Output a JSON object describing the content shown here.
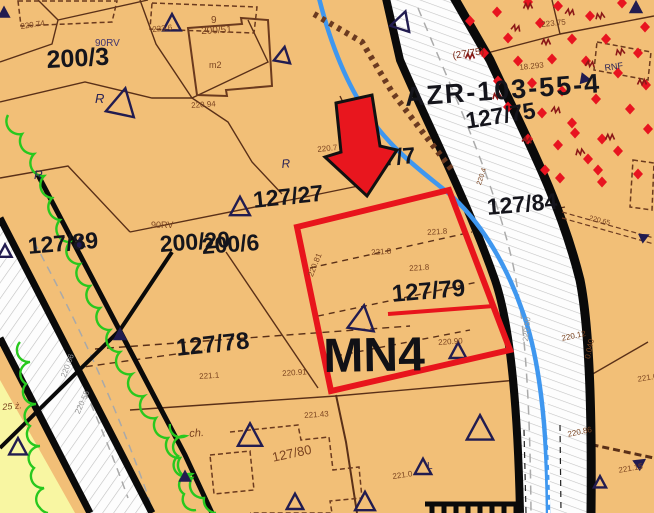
{
  "map": {
    "zone_code": "MN4",
    "highlighted_parcel": "127/79",
    "plan_reference": "AZR-103-55-4",
    "colors": {
      "background": "#f2bf77",
      "road_fill": "#fdfdfd",
      "outline_red": "#e8141c",
      "arrow_red": "#e8161e",
      "stream_blue": "#3f97ef",
      "vegetation_green": "#28c81e",
      "meadow_yellow": "#f8f6a2",
      "diamond_red": "#e81420",
      "symbol_navy": "#221c50",
      "zigzag_darkred": "#8b1717",
      "boundary_brown": "#6b3a20",
      "label_black": "#15151c",
      "label_brown": "#7b4420",
      "label_gray": "#969696"
    },
    "labels": [
      {
        "t": "200/3",
        "x": 46,
        "y": 48,
        "s": 25,
        "c": "#15151c",
        "r": -3,
        "w": 700
      },
      {
        "t": "AZR-103-55-4",
        "x": 404,
        "y": 84,
        "s": 27,
        "c": "#15151c",
        "r": -4,
        "w": 700,
        "ls": 2
      },
      {
        "t": "127/75",
        "x": 464,
        "y": 110,
        "s": 23,
        "c": "#15151c",
        "r": -9,
        "w": 700
      },
      {
        "t": "127/7",
        "x": 357,
        "y": 149,
        "s": 23,
        "c": "#15151c",
        "r": -5,
        "w": 700
      },
      {
        "t": "127/84",
        "x": 486,
        "y": 196,
        "s": 23,
        "c": "#15151c",
        "r": -5,
        "w": 700
      },
      {
        "t": "127/27",
        "x": 252,
        "y": 189,
        "s": 23,
        "c": "#15151c",
        "r": -6,
        "w": 700
      },
      {
        "t": "127/89",
        "x": 27,
        "y": 235,
        "s": 23,
        "c": "#15151c",
        "r": -5,
        "w": 700
      },
      {
        "t": "200/20",
        "x": 159,
        "y": 233,
        "s": 23,
        "c": "#15151c",
        "r": -4,
        "w": 700
      },
      {
        "t": "200/6",
        "x": 201,
        "y": 235,
        "s": 23,
        "c": "#15151c",
        "r": -4,
        "w": 700
      },
      {
        "t": "127/79",
        "x": 391,
        "y": 283,
        "s": 24,
        "c": "#15151c",
        "r": -5,
        "w": 700
      },
      {
        "t": "MN4",
        "x": 323,
        "y": 333,
        "s": 48,
        "c": "#111116",
        "r": -1,
        "w": 800
      },
      {
        "t": "127/78",
        "x": 175,
        "y": 337,
        "s": 24,
        "c": "#15151c",
        "r": -6,
        "w": 700
      },
      {
        "t": "220.74",
        "x": 20,
        "y": 23,
        "s": 8,
        "c": "#7b4420",
        "r": -8
      },
      {
        "t": "223.6",
        "x": 152,
        "y": 26,
        "s": 8,
        "c": "#7b4420",
        "r": -6
      },
      {
        "t": "9",
        "x": 211,
        "y": 16,
        "s": 10,
        "c": "#7b4420",
        "r": 0
      },
      {
        "t": "200/51",
        "x": 201,
        "y": 27,
        "s": 10,
        "c": "#7b4420",
        "r": -3
      },
      {
        "t": "m2",
        "x": 209,
        "y": 61,
        "s": 9,
        "c": "#7b4420",
        "r": 0
      },
      {
        "t": "220.94",
        "x": 191,
        "y": 102,
        "s": 8,
        "c": "#7b4420",
        "r": -4
      },
      {
        "t": "223.75",
        "x": 541,
        "y": 21,
        "s": 8,
        "c": "#7b4420",
        "r": -6
      },
      {
        "t": "18.293",
        "x": 519,
        "y": 64,
        "s": 8,
        "c": "#7b4420",
        "r": -6
      },
      {
        "t": "(27/75)",
        "x": 452,
        "y": 52,
        "s": 10,
        "c": "#7b2a18",
        "r": -9
      },
      {
        "t": "220.7",
        "x": 317,
        "y": 146,
        "s": 8,
        "c": "#7b4420",
        "r": -6
      },
      {
        "t": "90RV",
        "x": 95,
        "y": 39,
        "s": 10,
        "c": "#41356e",
        "r": 0
      },
      {
        "t": "90RV",
        "x": 151,
        "y": 221,
        "s": 9,
        "c": "#7b4420",
        "r": 0
      },
      {
        "t": "R",
        "x": 95,
        "y": 92,
        "s": 13,
        "c": "#2a2356",
        "r": 0,
        "it": 1
      },
      {
        "t": "R",
        "x": 34,
        "y": 169,
        "s": 12,
        "c": "#2a2356",
        "r": 0,
        "it": 1
      },
      {
        "t": "R",
        "x": 281,
        "y": 158,
        "s": 12,
        "c": "#2a2356",
        "r": -5,
        "it": 1
      },
      {
        "t": "RNF",
        "x": 604,
        "y": 64,
        "s": 9,
        "c": "#2a2356",
        "r": -8
      },
      {
        "t": "ch.",
        "x": 189,
        "y": 429,
        "s": 11,
        "c": "#7b4420",
        "r": -4,
        "it": 1
      },
      {
        "t": "127/80",
        "x": 271,
        "y": 451,
        "s": 13,
        "c": "#7b4420",
        "r": -12
      },
      {
        "t": "221.0",
        "x": 392,
        "y": 473,
        "s": 8,
        "c": "#7b4420",
        "r": -8
      },
      {
        "t": "L",
        "x": 427,
        "y": 462,
        "s": 10,
        "c": "#2a2356",
        "r": 0
      },
      {
        "t": "221.43",
        "x": 304,
        "y": 412,
        "s": 8,
        "c": "#7b4420",
        "r": -4
      },
      {
        "t": "220.91",
        "x": 282,
        "y": 370,
        "s": 8,
        "c": "#7b4420",
        "r": -4
      },
      {
        "t": "221.1",
        "x": 199,
        "y": 373,
        "s": 8,
        "c": "#7b4420",
        "r": -4
      },
      {
        "t": "221.8",
        "x": 371,
        "y": 249,
        "s": 8,
        "c": "#7b4420",
        "r": -4
      },
      {
        "t": "221.8",
        "x": 409,
        "y": 265,
        "s": 8,
        "c": "#7b4420",
        "r": -4
      },
      {
        "t": "221.8",
        "x": 427,
        "y": 229,
        "s": 8,
        "c": "#7b4420",
        "r": -4
      },
      {
        "t": "220.90",
        "x": 438,
        "y": 339,
        "s": 8,
        "c": "#7b4420",
        "r": -4
      },
      {
        "t": "220.81",
        "x": 307,
        "y": 275,
        "s": 8,
        "c": "#7b4420",
        "r": -68
      },
      {
        "t": "220.4",
        "x": 476,
        "y": 184,
        "s": 7,
        "c": "#7b4420",
        "r": -72
      },
      {
        "t": "220.12",
        "x": 561,
        "y": 335,
        "s": 8,
        "c": "#7b4420",
        "r": -12
      },
      {
        "t": "0.040",
        "x": 584,
        "y": 358,
        "s": 8,
        "c": "#7b4420",
        "r": -78
      },
      {
        "t": "221.6",
        "x": 637,
        "y": 376,
        "s": 8,
        "c": "#7b4420",
        "r": -10
      },
      {
        "t": "220.86",
        "x": 567,
        "y": 431,
        "s": 8,
        "c": "#7b4420",
        "r": -12
      },
      {
        "t": "221.15",
        "x": 618,
        "y": 467,
        "s": 8,
        "c": "#7b4420",
        "r": -10
      },
      {
        "t": "220.65",
        "x": 590,
        "y": 215,
        "s": 7,
        "c": "#7b4420",
        "r": 14
      },
      {
        "t": "25 ż.",
        "x": 2,
        "y": 403,
        "s": 9,
        "c": "#7b4420",
        "r": -5,
        "it": 1
      },
      {
        "t": "220.06",
        "x": 60,
        "y": 376,
        "s": 8,
        "c": "#969696",
        "r": -70
      },
      {
        "t": "220.55",
        "x": 74,
        "y": 412,
        "s": 8,
        "c": "#969696",
        "r": -66
      },
      {
        "t": "220.50",
        "x": 522,
        "y": 341,
        "s": 8,
        "c": "#969696",
        "r": -84
      }
    ],
    "symbols": {
      "open_triangles": [
        [
          172,
          24,
          16,
          0
        ],
        [
          283,
          56,
          15,
          10
        ],
        [
          122,
          104,
          26,
          12
        ],
        [
          402,
          22,
          18,
          18
        ],
        [
          240,
          208,
          18,
          0
        ],
        [
          362,
          320,
          24,
          8
        ],
        [
          458,
          352,
          15,
          0
        ],
        [
          250,
          437,
          22,
          0
        ],
        [
          365,
          503,
          18,
          0
        ],
        [
          480,
          430,
          24,
          0
        ],
        [
          18,
          448,
          16,
          0
        ],
        [
          423,
          468,
          15,
          0
        ],
        [
          295,
          503,
          15,
          0
        ],
        [
          600,
          483,
          11,
          0
        ],
        [
          5,
          252,
          12,
          0
        ]
      ],
      "filled_triangles": [
        [
          4,
          13,
          12,
          0
        ],
        [
          80,
          243,
          11,
          0
        ],
        [
          120,
          335,
          13,
          0
        ],
        [
          185,
          477,
          12,
          0
        ],
        [
          636,
          8,
          13,
          0
        ],
        [
          585,
          79,
          11,
          100
        ],
        [
          644,
          237,
          10,
          65
        ],
        [
          640,
          463,
          12,
          55
        ]
      ],
      "red_diamonds": [
        [
          497,
          12
        ],
        [
          528,
          2
        ],
        [
          558,
          6
        ],
        [
          590,
          16
        ],
        [
          622,
          3
        ],
        [
          645,
          27
        ],
        [
          470,
          21
        ],
        [
          508,
          38
        ],
        [
          540,
          23
        ],
        [
          572,
          39
        ],
        [
          606,
          39
        ],
        [
          638,
          53
        ],
        [
          484,
          53
        ],
        [
          518,
          61
        ],
        [
          552,
          59
        ],
        [
          586,
          61
        ],
        [
          618,
          73
        ],
        [
          646,
          85
        ],
        [
          498,
          81
        ],
        [
          532,
          83
        ],
        [
          562,
          91
        ],
        [
          596,
          99
        ],
        [
          630,
          109
        ],
        [
          648,
          129
        ],
        [
          508,
          107
        ],
        [
          542,
          113
        ],
        [
          572,
          123
        ],
        [
          602,
          139
        ],
        [
          558,
          145
        ],
        [
          528,
          139
        ],
        [
          588,
          159
        ],
        [
          618,
          151
        ],
        [
          575,
          133
        ],
        [
          598,
          170
        ],
        [
          545,
          170
        ],
        [
          560,
          178
        ],
        [
          602,
          182
        ],
        [
          638,
          174
        ]
      ],
      "zigzag_marks": [
        [
          528,
          6,
          0
        ],
        [
          570,
          12,
          10
        ],
        [
          600,
          16,
          -10
        ],
        [
          470,
          56,
          0
        ],
        [
          516,
          28,
          15
        ],
        [
          546,
          42,
          0
        ],
        [
          620,
          52,
          -12
        ],
        [
          590,
          64,
          8
        ],
        [
          642,
          82,
          0
        ],
        [
          497,
          96,
          -8
        ],
        [
          556,
          110,
          10
        ],
        [
          610,
          137,
          0
        ],
        [
          580,
          152,
          -10
        ],
        [
          527,
          140,
          12
        ]
      ]
    }
  }
}
